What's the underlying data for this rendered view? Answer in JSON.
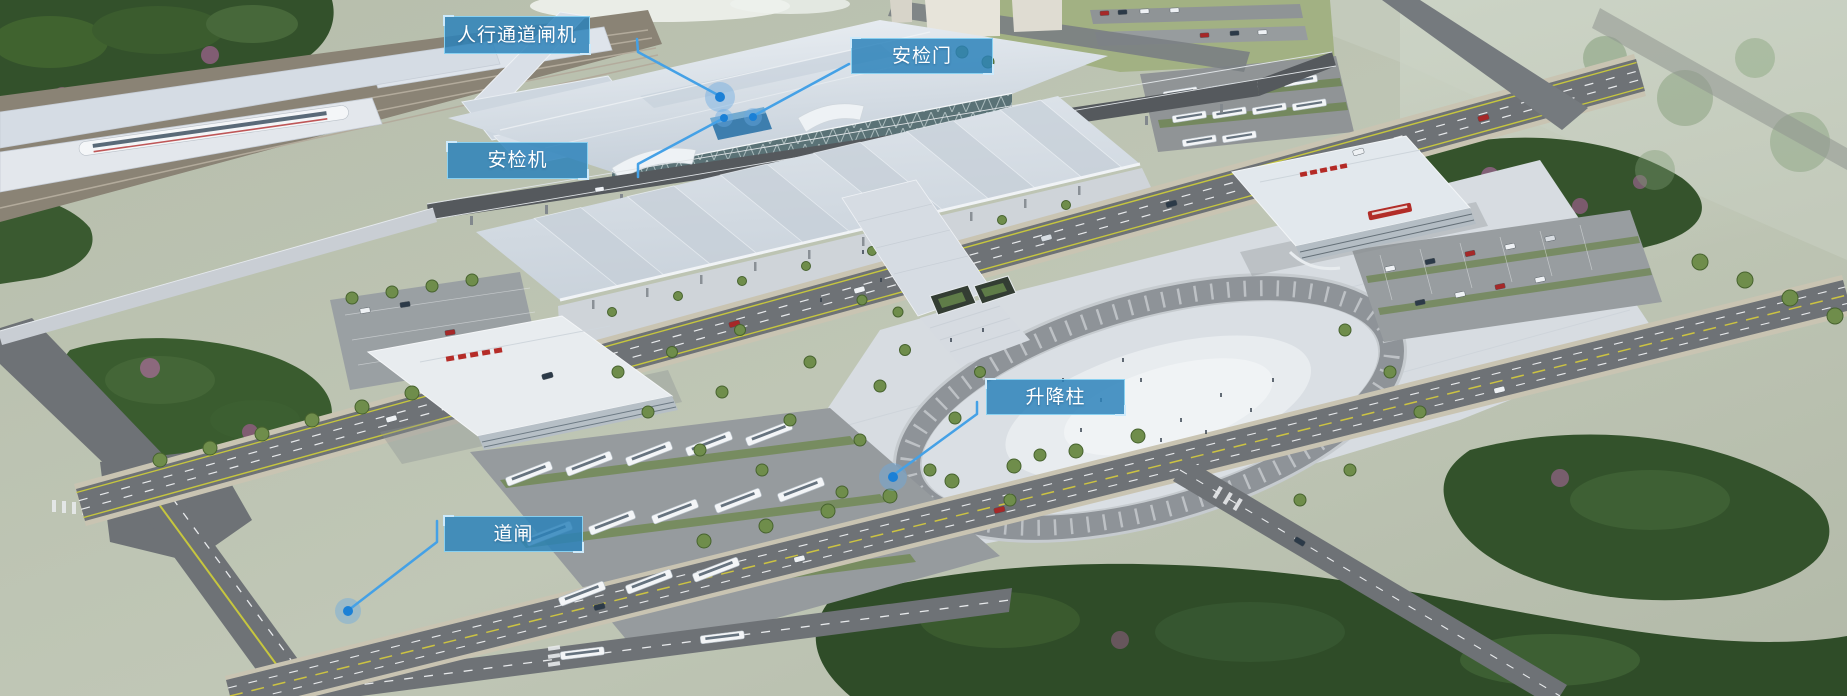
{
  "style": {
    "label_fill": "rgba(43,130,186,0.84)",
    "label_border": "rgba(141,212,242,0.95)",
    "label_text": "#ffffff",
    "line_color": "#45a1e6",
    "dot_color": "#1b80d6",
    "halo_color": "rgba(105,170,226,0.42)"
  },
  "callouts": [
    {
      "id": "pedestrian-gate",
      "label": "人行通道闸机",
      "box": {
        "x": 444,
        "y": 16,
        "w": 146,
        "h": 38
      },
      "line": [
        [
          637,
          39
        ],
        [
          638,
          52
        ],
        [
          718,
          95
        ]
      ],
      "dot": {
        "x": 720,
        "y": 97,
        "r": 5,
        "halo_r": 15
      }
    },
    {
      "id": "security-door",
      "label": "安检门",
      "box": {
        "x": 851,
        "y": 38,
        "w": 142,
        "h": 36
      },
      "line": [
        [
          849,
          64
        ],
        [
          755,
          115
        ]
      ],
      "dot": {
        "x": 753,
        "y": 117,
        "r": 4,
        "halo_r": 9
      }
    },
    {
      "id": "security-scanner",
      "label": "安检机",
      "box": {
        "x": 447,
        "y": 142,
        "w": 141,
        "h": 37
      },
      "line": [
        [
          638,
          177
        ],
        [
          638,
          164
        ],
        [
          722,
          119
        ]
      ],
      "dot": {
        "x": 724,
        "y": 118,
        "r": 4,
        "halo_r": 9
      }
    },
    {
      "id": "lift-bollard",
      "label": "升降柱",
      "box": {
        "x": 986,
        "y": 379,
        "w": 139,
        "h": 36
      },
      "line": [
        [
          977,
          402
        ],
        [
          977,
          414
        ],
        [
          895,
          474
        ]
      ],
      "dot": {
        "x": 893,
        "y": 477,
        "r": 5,
        "halo_r": 14
      }
    },
    {
      "id": "barrier-gate",
      "label": "道闸",
      "box": {
        "x": 444,
        "y": 516,
        "w": 139,
        "h": 36
      },
      "line": [
        [
          437,
          521
        ],
        [
          437,
          542
        ],
        [
          350,
          609
        ]
      ],
      "dot": {
        "x": 348,
        "y": 611,
        "r": 5,
        "halo_r": 13
      }
    }
  ]
}
